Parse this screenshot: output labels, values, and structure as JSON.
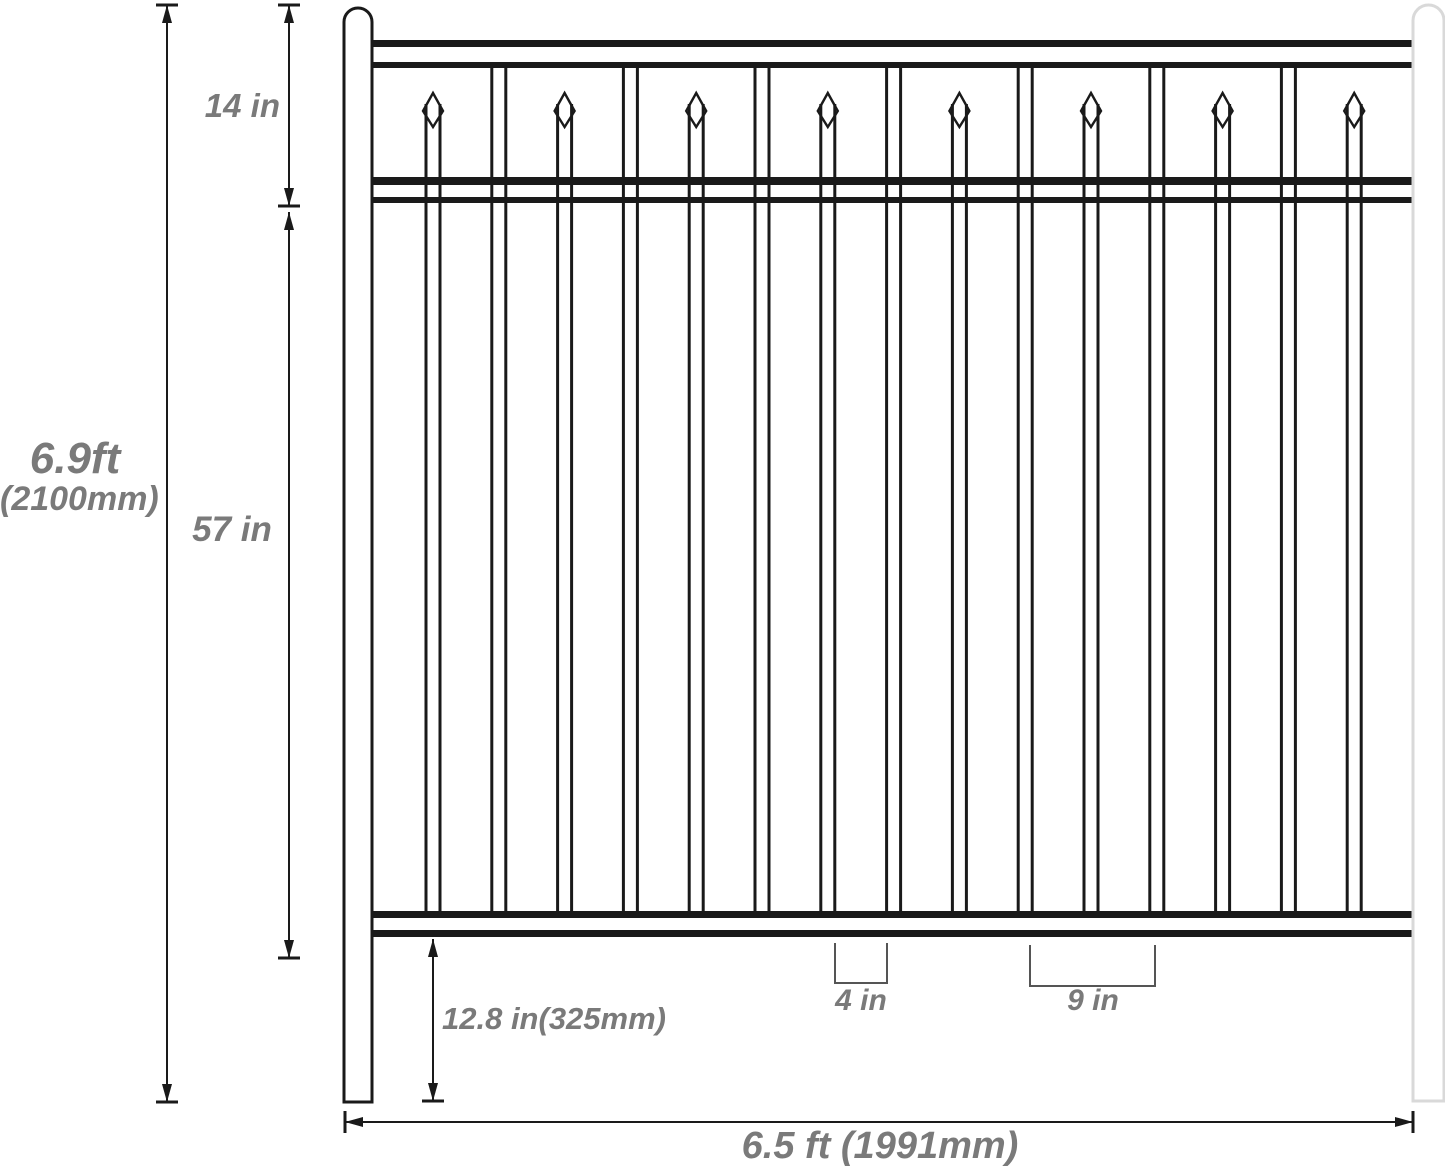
{
  "diagram": {
    "type": "fence-panel-dimension-drawing",
    "background": "#ffffff"
  },
  "colors": {
    "line": "#1a1a1a",
    "light_post": "#d9d9d9",
    "bracket": "#555555",
    "label": "#7a7a7a"
  },
  "labels": {
    "overall_height_ft": "6.9ft",
    "overall_height_mm": "(2100mm)",
    "top_section_height": "14 in",
    "picket_section_height": "57 in",
    "ground_clearance": "12.8 in(325mm)",
    "picket_gap": "4 in",
    "picket_spacing": "9 in",
    "overall_width": "6.5 ft (1991mm)"
  },
  "fence": {
    "canvas": {
      "w": 1445,
      "h": 1169
    },
    "posts": {
      "left": {
        "x": 344,
        "w": 28,
        "top": 8,
        "bottom": 1102,
        "stroke": "#1a1a1a"
      },
      "right": {
        "x": 1413,
        "w": 31,
        "top": 5,
        "bottom": 1101,
        "stroke": "#d9d9d9"
      }
    },
    "rails": {
      "x1": 372,
      "x2": 1413,
      "bands": [
        {
          "name": "top-rail",
          "lines": [
            [
              40,
              7
            ],
            [
              62,
              6
            ]
          ]
        },
        {
          "name": "middle-rail",
          "lines": [
            [
              177,
              8
            ],
            [
              197,
              6
            ]
          ]
        },
        {
          "name": "bottom-rail",
          "lines": [
            [
              911,
              7
            ],
            [
              930,
              7
            ]
          ]
        }
      ]
    },
    "pickets": {
      "count": 15,
      "first_center": 433,
      "spacing": 65.8,
      "half_width": 7,
      "line_width": 3,
      "plain_top": 62,
      "bottom": 911,
      "spear": {
        "tip_y": 93,
        "shoulder_y": 111,
        "bottom_y": 127,
        "half_width": 10,
        "shaft_top": 104
      }
    },
    "dimensions": [
      {
        "name": "overall-height",
        "type": "v",
        "x": 167,
        "y1": 5,
        "y2": 1102,
        "tick1": true,
        "tick2": true
      },
      {
        "name": "top-section",
        "type": "v",
        "x": 289,
        "y1": 5,
        "y2": 206,
        "tick1": true,
        "tick2": true
      },
      {
        "name": "picket-section",
        "type": "v",
        "x": 289,
        "y1": 212,
        "y2": 958,
        "tick1": false,
        "tick2": true
      },
      {
        "name": "ground-clearance",
        "type": "v",
        "x": 433,
        "y1": 939,
        "y2": 1101,
        "tick1": false,
        "tick2": true
      },
      {
        "name": "overall-width",
        "type": "h",
        "y": 1122,
        "x1": 345,
        "x2": 1413,
        "tick1": true,
        "tick2": true
      }
    ],
    "brackets": [
      {
        "name": "bracket-4in",
        "x1": 835,
        "x2": 887,
        "y_top": 943,
        "y_bot": 983
      },
      {
        "name": "bracket-9in",
        "x1": 1030,
        "x2": 1155,
        "y_top": 945,
        "y_bot": 986
      }
    ]
  }
}
